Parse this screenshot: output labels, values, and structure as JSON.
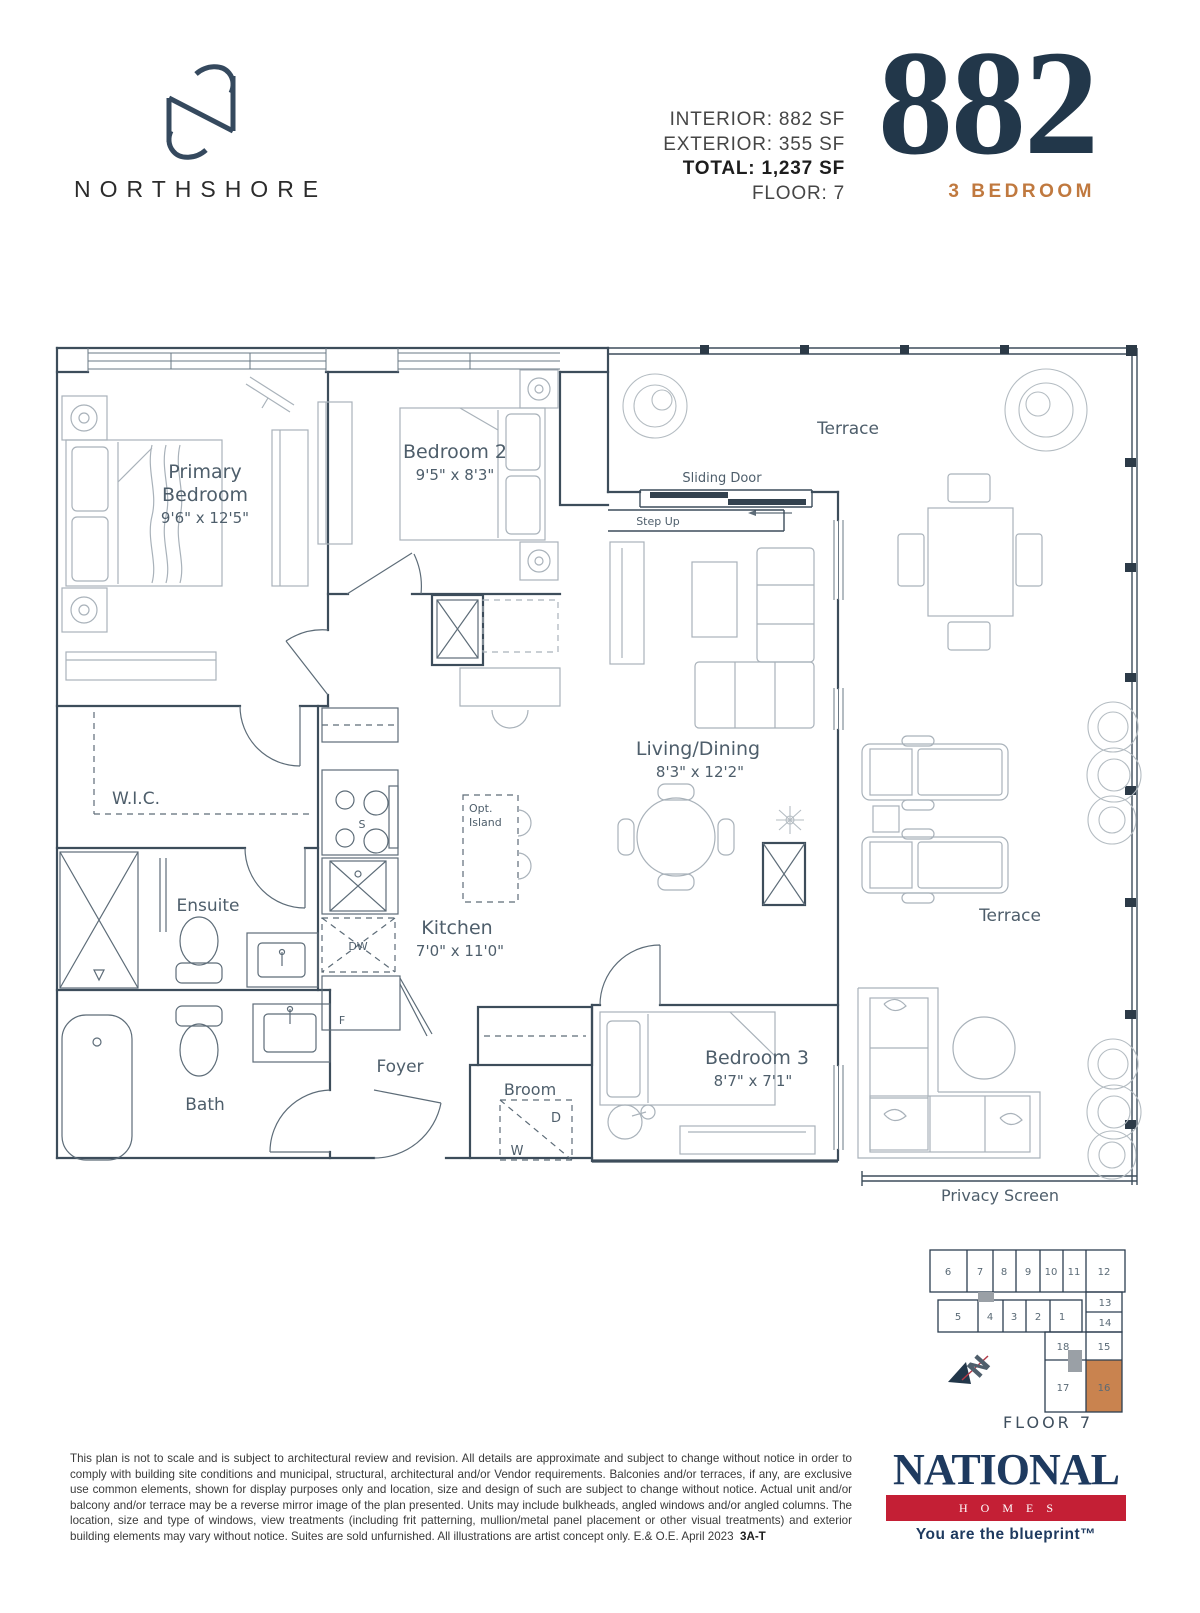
{
  "colors": {
    "navy": "#22374a",
    "orange_accent": "#c0793f",
    "orange_unit_highlight": "#c9834f",
    "red_logo_bar": "#c41f35",
    "plan_line": "#3d4d5b"
  },
  "header": {
    "brand": "NORTHSHORE",
    "stats": [
      "INTERIOR: 882 SF",
      "EXTERIOR: 355 SF",
      "TOTAL: 1,237 SF",
      "FLOOR:  7"
    ],
    "unit_number": "882",
    "unit_type": "3 BEDROOM"
  },
  "plan": {
    "rooms": {
      "primary": {
        "line1": "Primary",
        "line2": "Bedroom",
        "dims": "9'6\" x 12'5\""
      },
      "bedroom2": {
        "line1": "Bedroom 2",
        "dims": "9'5\" x 8'3\""
      },
      "living": {
        "line1": "Living/Dining",
        "dims": "8'3\" x 12'2\""
      },
      "kitchen": {
        "line1": "Kitchen",
        "dims": "7'0\" x 11'0\""
      },
      "bedroom3": {
        "line1": "Bedroom 3",
        "dims": "8'7\" x 7'1\""
      }
    },
    "labels": {
      "wic": "W.I.C.",
      "ensuite": "Ensuite",
      "bath": "Bath",
      "foyer": "Foyer",
      "broom": "Broom",
      "terrace_top": "Terrace",
      "terrace_right": "Terrace",
      "privacy_screen": "Privacy Screen",
      "sliding_door": "Sliding Door",
      "step_up": "Step Up",
      "opt_island1": "Opt.",
      "opt_island2": "Island"
    },
    "fixtures": {
      "stove": "S",
      "dishwasher": "DW",
      "fridge": "F",
      "dryer": "D",
      "washer": "W"
    }
  },
  "keyplan": {
    "floor_label": "FLOOR 7",
    "highlighted_unit": "16",
    "units": [
      "6",
      "7",
      "8",
      "9",
      "10",
      "11",
      "12",
      "13",
      "14",
      "5",
      "4",
      "3",
      "2",
      "1",
      "18",
      "15",
      "17",
      "16"
    ]
  },
  "footer": {
    "disclaimer": "This plan is not to scale and is subject to architectural review and revision. All details are approximate and subject to change without notice in order to comply with building site conditions and municipal, structural, architectural and/or Vendor requirements. Balconies and/or terraces, if any, are exclusive use common elements, shown for display purposes only and location, size and design of such are subject to change without notice. Actual unit and/or balcony and/or terrace may be a reverse mirror image of the plan presented. Units may include bulkheads, angled windows and/or angled columns. The location, size and type of windows, view treatments (including frit patterning, mullion/metal panel placement or other visual treatments) and exterior building elements may vary without notice. Suites are sold unfurnished. All illustrations are artist concept only. E.& O.E. April 2023",
    "plan_code": "3A-T",
    "brand": "NATIONAL",
    "brand_sub": "HOMES",
    "tagline": "You are the blueprint™"
  }
}
